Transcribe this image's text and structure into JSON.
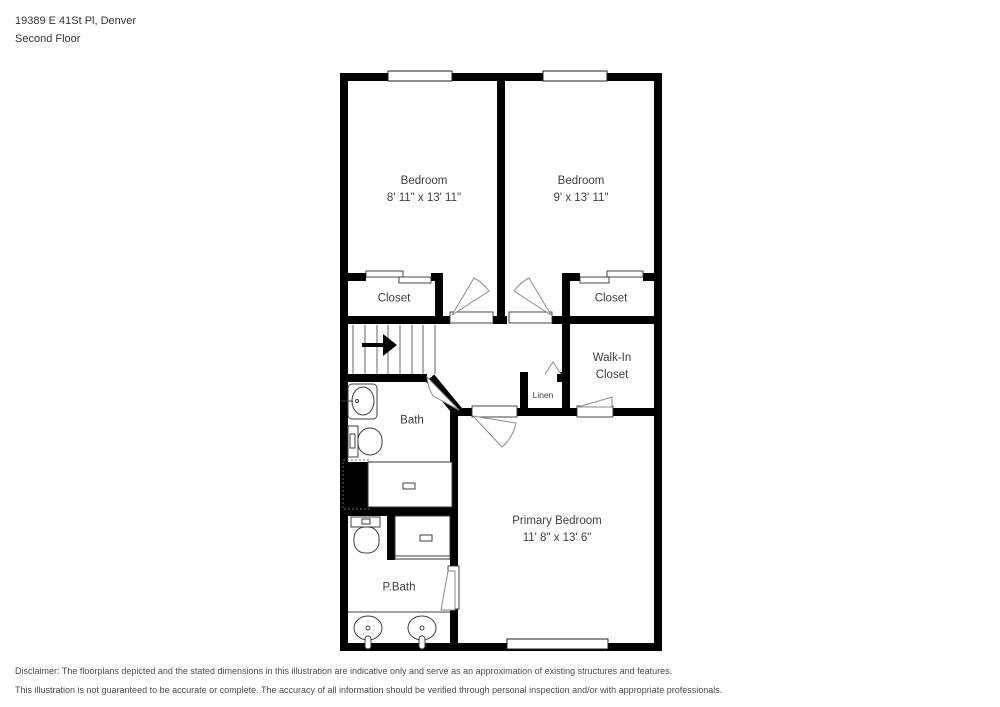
{
  "header": {
    "address": "19389 E 41St Pl, Denver",
    "floor_label": "Second Floor"
  },
  "floorplan": {
    "wall_color": "#000000",
    "door_arc_color": "#8a8a8a",
    "fixture_line_color": "#3f3f3f",
    "label_color": "#3d3d3d",
    "rooms": {
      "bedroom1": {
        "name": "Bedroom",
        "dims": "8' 11\" x 13' 11\""
      },
      "bedroom2": {
        "name": "Bedroom",
        "dims": "9' x 13' 11\""
      },
      "closet1": {
        "name": "Closet"
      },
      "closet2": {
        "name": "Closet"
      },
      "walkin": {
        "name_line1": "Walk-In",
        "name_line2": "Closet"
      },
      "linen": {
        "name": "Linen"
      },
      "bath": {
        "name": "Bath"
      },
      "pbath": {
        "name": "P.Bath"
      },
      "primary": {
        "name": "Primary Bedroom",
        "dims": "11' 8\" x 13' 6\""
      }
    }
  },
  "disclaimer": {
    "line1": "Disclaimer: The floorplans depicted and the stated dimensions in this illustration are indicative only and serve as an approximation of existing structures and features.",
    "line2": "This illustration is not guaranteed to be accurate or complete. The accuracy of all information should be verified through personal inspection and/or with appropriate professionals."
  }
}
